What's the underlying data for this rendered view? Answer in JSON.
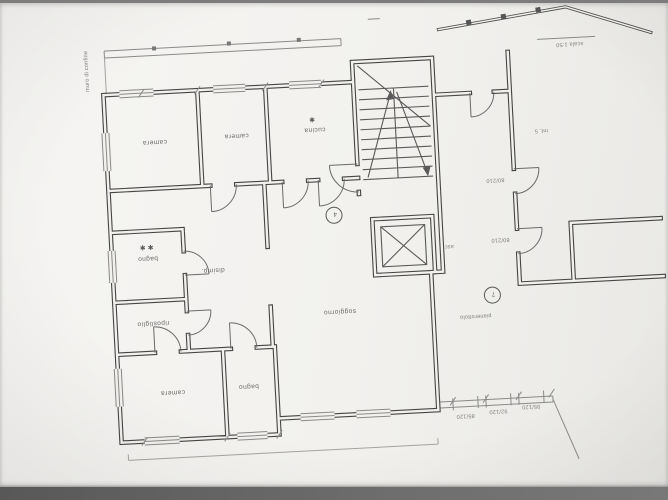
{
  "photo": {
    "background": "#7d7d7d",
    "paper": "#f2f1ee",
    "ink": "#454545"
  },
  "plan": {
    "rooms": [
      {
        "id": "camera-1",
        "label": "camera"
      },
      {
        "id": "camera-2",
        "label": "camera"
      },
      {
        "id": "cucina",
        "label": "cucina",
        "mark": "✱"
      },
      {
        "id": "bagno-1",
        "label": "bagno",
        "mark": "✱ ✱"
      },
      {
        "id": "ripostiglio",
        "label": "ripostiglio"
      },
      {
        "id": "disimpegno",
        "label": "disimp."
      },
      {
        "id": "soggiorno",
        "label": "soggiorno"
      },
      {
        "id": "camera-3",
        "label": "camera"
      },
      {
        "id": "bagno-2",
        "label": "bagno"
      }
    ],
    "elevator": {
      "label": "asc."
    },
    "unit_badges": [
      {
        "value": "4"
      },
      {
        "value": "7"
      }
    ],
    "door_sizes": [
      {
        "value": "80/210"
      },
      {
        "value": "80/210"
      }
    ],
    "window_sizes": [
      {
        "value": "85/120"
      },
      {
        "value": "92/120"
      },
      {
        "value": "95/120"
      }
    ],
    "notes": {
      "corner": "scala 1:50",
      "side": "muro di confine",
      "landing": "pianerottolo",
      "neighbor": "int. 5"
    }
  }
}
